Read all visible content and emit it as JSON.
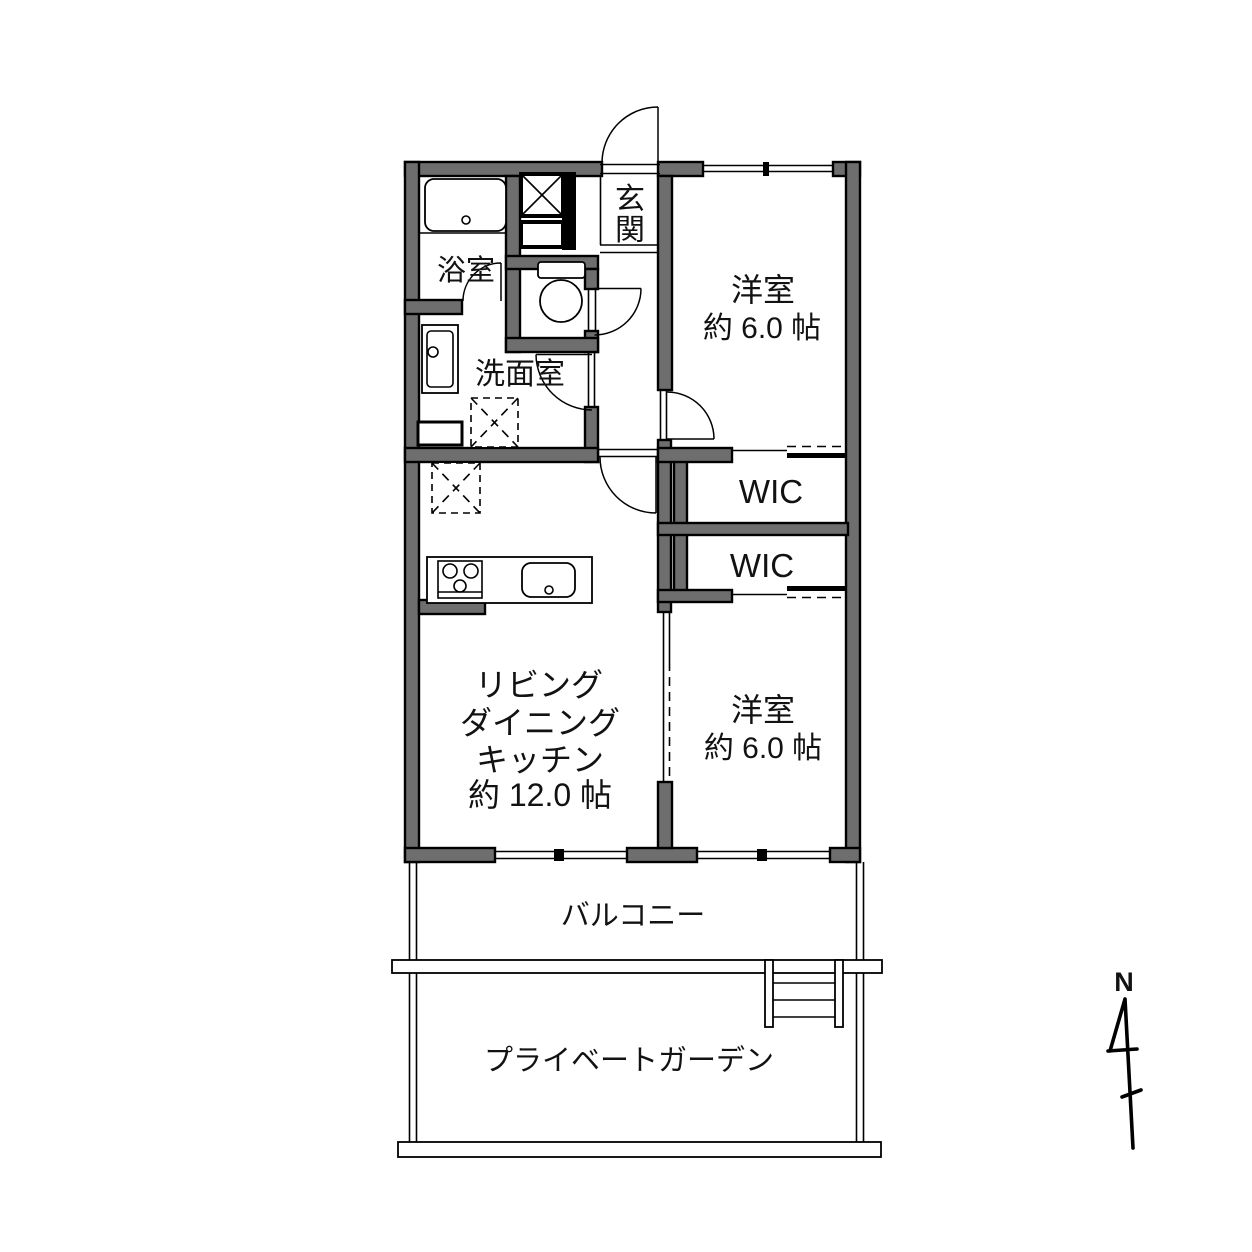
{
  "page": {
    "background": "#ffffff",
    "type": "apartment-floor-plan"
  },
  "colors": {
    "wall_fill": "#6e6e6e",
    "wall_outline": "#000000",
    "line": "#000000",
    "text": "#121212"
  },
  "rooms": {
    "genkan": {
      "label_chars": [
        "玄",
        "関"
      ]
    },
    "bathroom": {
      "label": "浴室"
    },
    "washroom": {
      "label": "洗面室"
    },
    "bedroom_top": {
      "lines": [
        "洋室",
        "約 6.0 帖"
      ]
    },
    "wic_1": {
      "label": "WIC"
    },
    "wic_2": {
      "label": "WIC"
    },
    "ldk": {
      "lines": [
        "リビング",
        "ダイニング",
        "キッチン",
        "約 12.0 帖"
      ]
    },
    "bedroom_bottom": {
      "lines": [
        "洋室",
        "約 6.0 帖"
      ]
    },
    "balcony": {
      "label": "バルコニー"
    },
    "private_garden": {
      "label": "プライベートガーデン"
    }
  },
  "compass": {
    "label": "N"
  },
  "icons": {
    "bathtub": "bathtub-icon",
    "toilet": "toilet-icon",
    "washbasin": "washbasin-icon",
    "washing_machine": "washing-machine-icon",
    "refrigerator": "refrigerator-icon",
    "stove": "stove-icon",
    "kitchen_sink": "kitchen-sink-icon",
    "pipe_space": "pipe-space-icon",
    "shoe_cabinet": "shoe-cabinet-icon",
    "garden_steps": "garden-steps-icon",
    "north_arrow": "north-arrow-icon"
  }
}
